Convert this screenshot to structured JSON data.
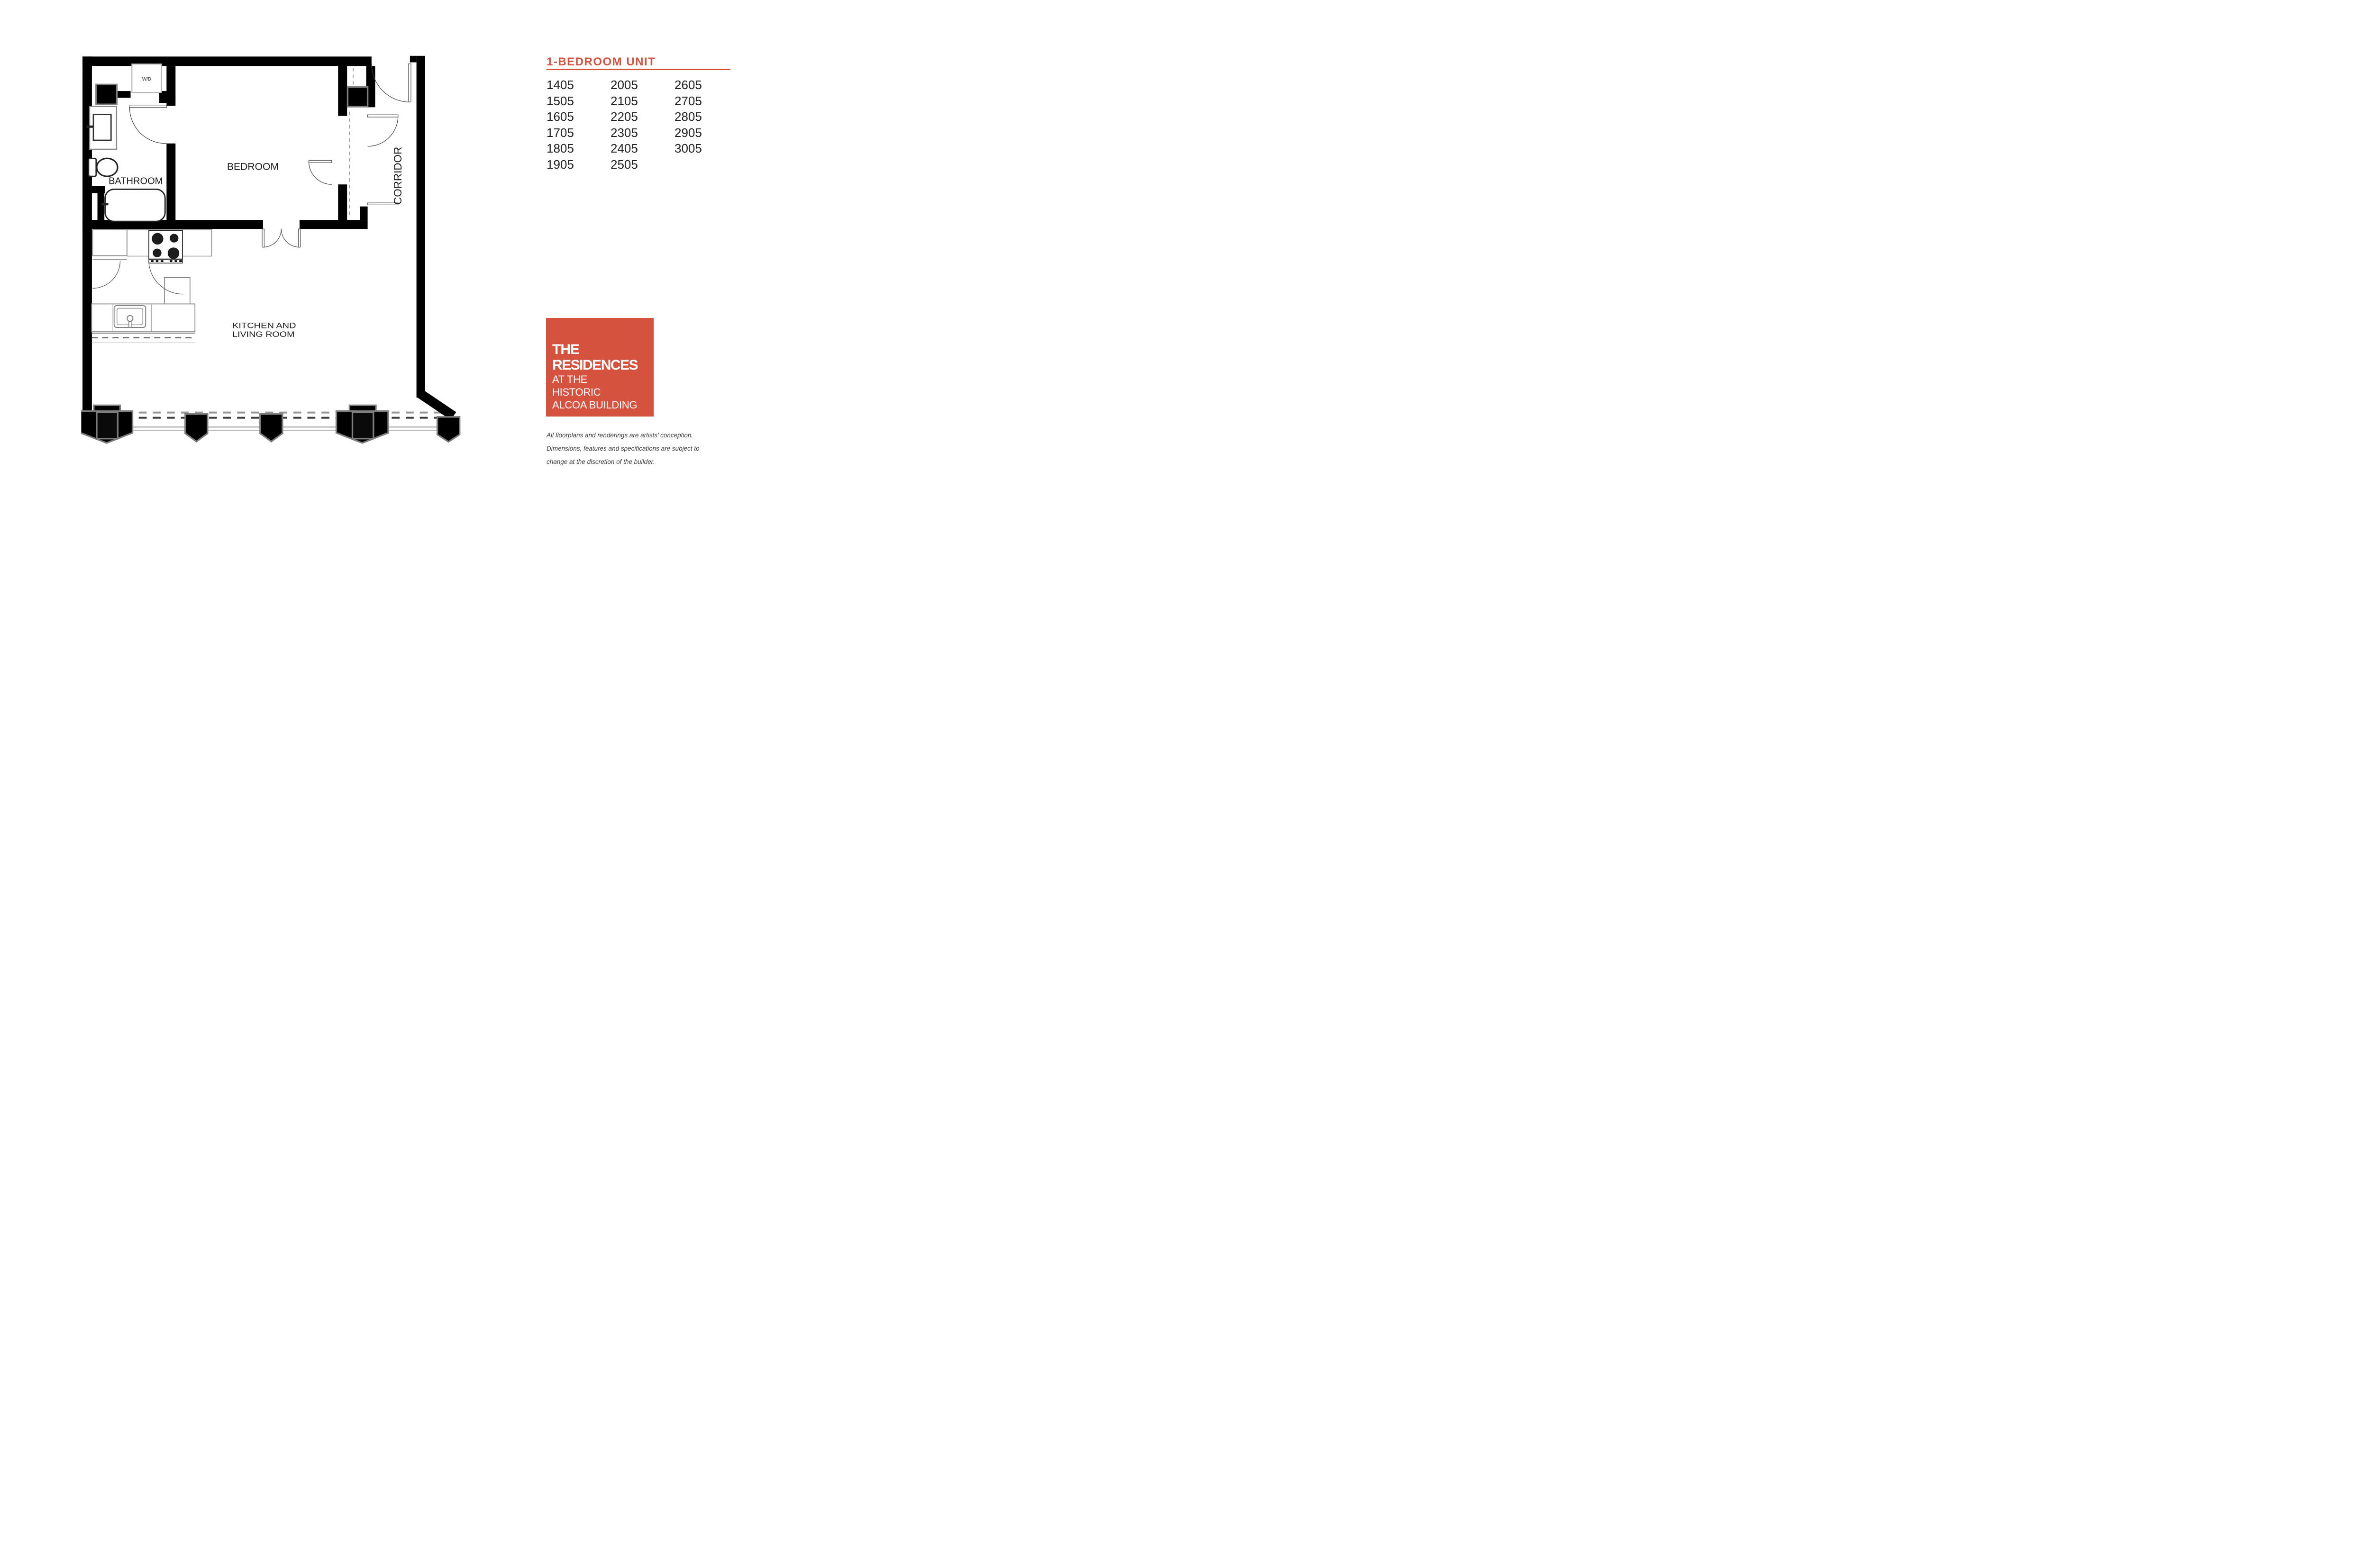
{
  "panel": {
    "title": "1-BEDROOM UNIT",
    "accent_color": "#D5523F",
    "unit_columns": [
      [
        "1405",
        "1505",
        "1605",
        "1705",
        "1805",
        "1905"
      ],
      [
        "2005",
        "2105",
        "2205",
        "2305",
        "2405",
        "2505"
      ],
      [
        "2605",
        "2705",
        "2805",
        "2905",
        "3005"
      ]
    ],
    "logo": {
      "line1": "THE",
      "line2": "RESIDENCES",
      "line3": "AT THE",
      "line4": "HISTORIC",
      "line5": "ALCOA BUILDING"
    },
    "disclaimer": {
      "line1": "All floorplans and renderings are artists’ conception.",
      "line2": "Dimensions, features and specifications are subject to",
      "line3": "change at the discretion of the builder."
    }
  },
  "floorplan": {
    "labels": {
      "wd": "W/D",
      "bathroom": "BATHROOM",
      "bedroom": "BEDROOM",
      "kitchen_line1": "KITCHEN AND",
      "kitchen_line2": "LIVING ROOM",
      "corridor": "CORRIDOR"
    }
  }
}
